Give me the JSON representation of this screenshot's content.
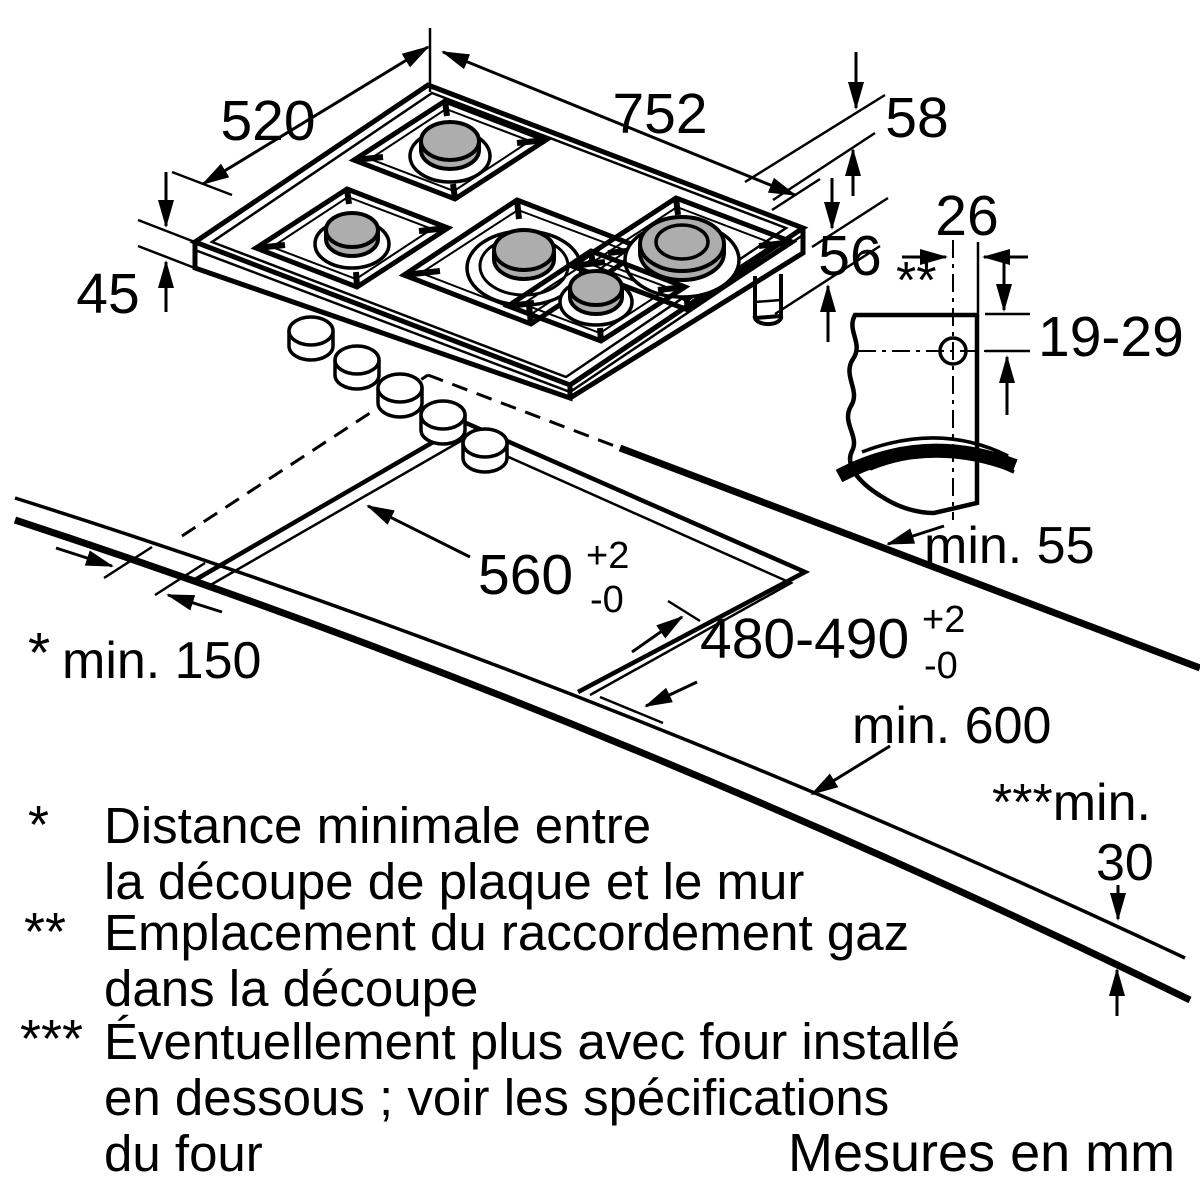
{
  "drawing": {
    "unit_note": "Mesures en mm",
    "hob": {
      "width": "752",
      "depth": "520",
      "height": "45",
      "conn_top": "58",
      "conn_side": "56"
    },
    "gas_detail": {
      "marker": "**",
      "offset": "26",
      "depth_range": "19-29"
    },
    "cutout": {
      "width": "560",
      "width_tol_up": "+2",
      "width_tol_down": "-0",
      "depth": "480-490",
      "depth_tol_up": "+2",
      "depth_tol_down": "-0"
    },
    "clearances": {
      "back_wall": "min. 55",
      "side_wall_marker": "*",
      "side_wall": "min. 150",
      "worktop_depth": "min. 600",
      "below_marker": "***min.",
      "below_value": "30"
    },
    "footnotes": [
      {
        "marker": "*",
        "lines": [
          "Distance minimale entre",
          "la découpe de plaque et le mur"
        ]
      },
      {
        "marker": "**",
        "lines": [
          "Emplacement du raccordement gaz",
          "dans la découpe"
        ]
      },
      {
        "marker": "***",
        "lines": [
          "Éventuellement plus avec four installé",
          "en dessous ; voir les spécifications",
          "du four"
        ]
      }
    ]
  }
}
